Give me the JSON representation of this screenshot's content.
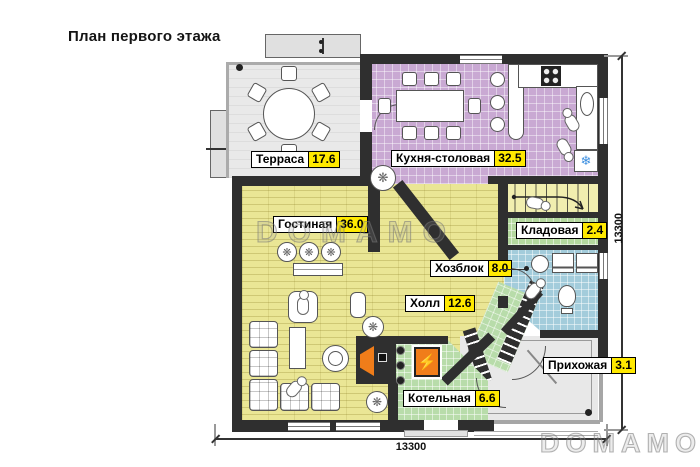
{
  "title": "План первого этажа",
  "watermark": {
    "center": "DOMAMO",
    "corner": "DOMAMO"
  },
  "dimensions": {
    "bottom": "13300",
    "right": "13300"
  },
  "rooms": [
    {
      "id": "terrace",
      "name": "Терраса",
      "area": "17.6"
    },
    {
      "id": "kitchen",
      "name": "Кухня-столовая",
      "area": "32.5"
    },
    {
      "id": "living",
      "name": "Гостиная",
      "area": "36.0"
    },
    {
      "id": "storage",
      "name": "Кладовая",
      "area": "2.4"
    },
    {
      "id": "utility",
      "name": "Хозблок",
      "area": "8.0"
    },
    {
      "id": "hall",
      "name": "Холл",
      "area": "12.6"
    },
    {
      "id": "entry",
      "name": "Прихожая",
      "area": "3.1"
    },
    {
      "id": "boiler",
      "name": "Котельная",
      "area": "6.6"
    }
  ],
  "icons": {
    "fridge_snowflake": "❄",
    "boiler_lightning": "⚡",
    "plant": "❋",
    "ceiling_light": "❋"
  },
  "colors": {
    "wall": "#2f2f2f",
    "terrace": "#e9e9e9",
    "kitchen": "#c9a9d3",
    "living": "#eae695",
    "stairs": "#f1eeaf",
    "storage": "#b4d89e",
    "utility": "#a3ccdb",
    "entry": "#e8e8e8",
    "boiler": "#b8dcaa",
    "badge": "#ffe900",
    "snowflake": "#3c8fe0",
    "fire": "#f07d1a"
  }
}
